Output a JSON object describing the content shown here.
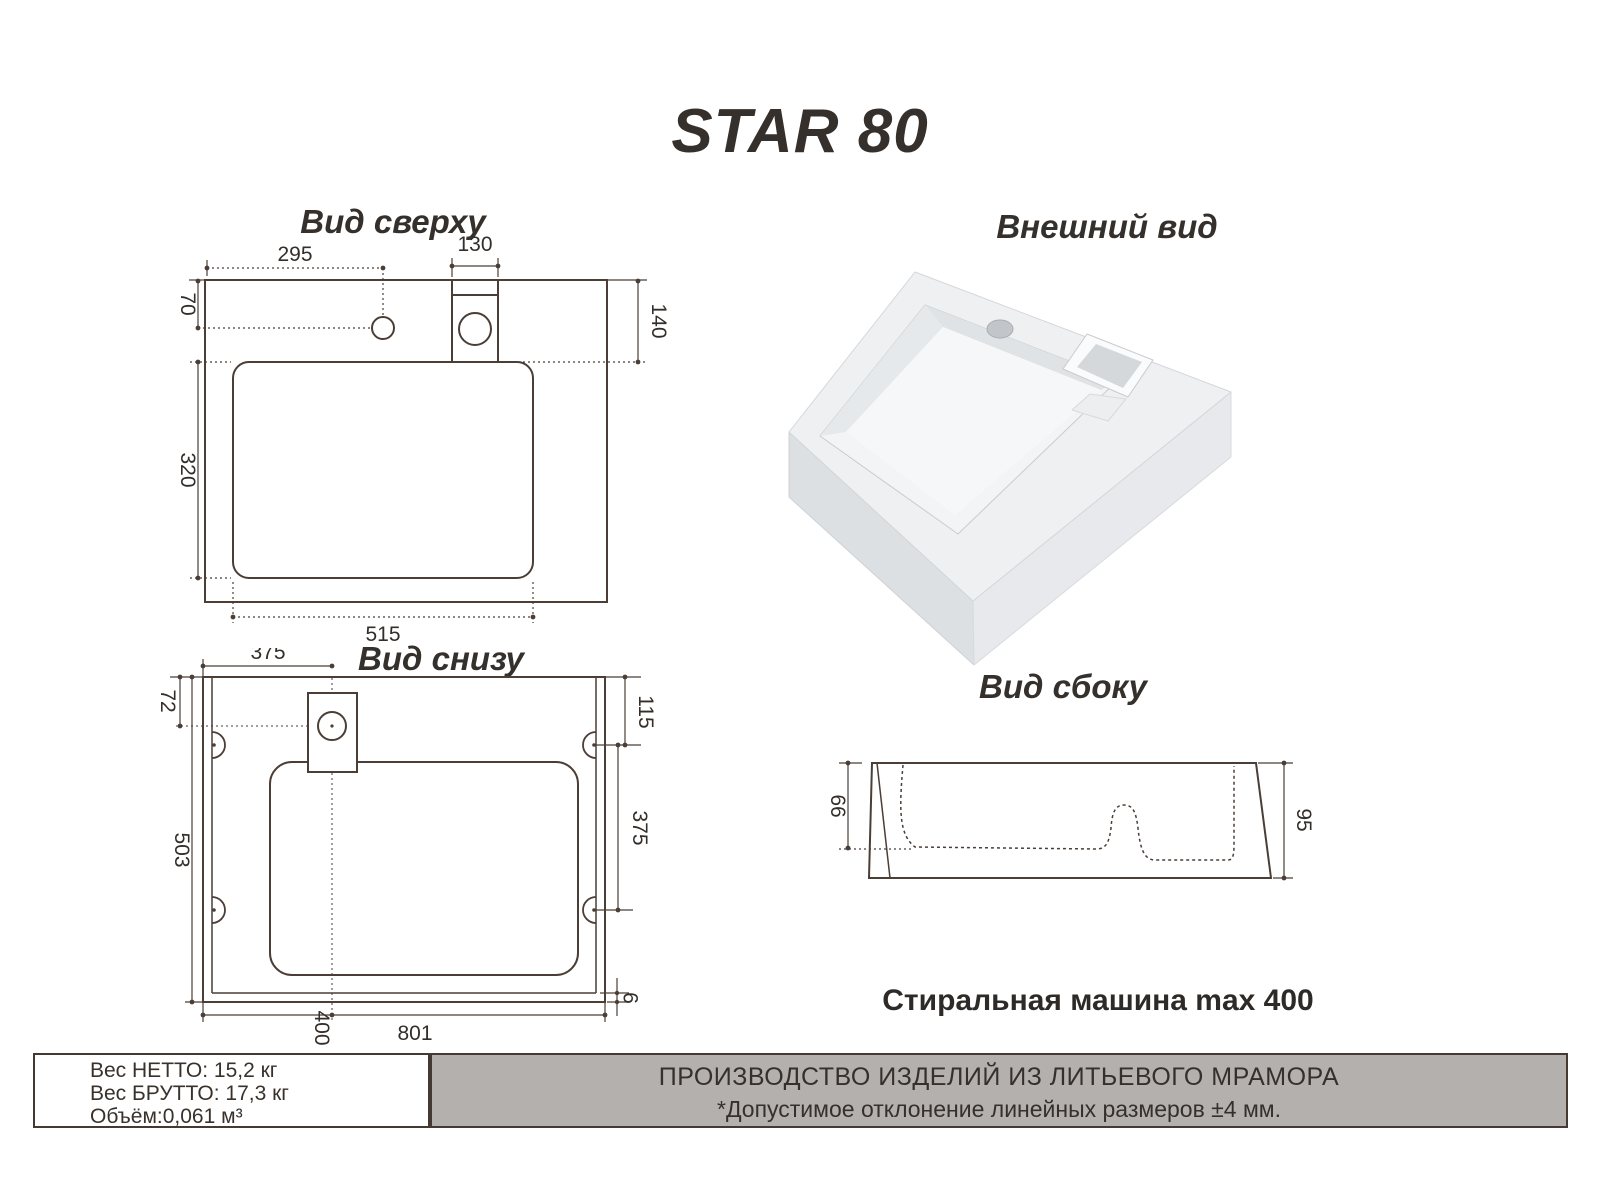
{
  "product": {
    "title": "STAR 80"
  },
  "views": {
    "top_view": {
      "title": "Вид сверху",
      "dims": {
        "faucet_x": "295",
        "drain_w": "130",
        "faucet_y": "70",
        "drain_h": "140",
        "basin_h": "320",
        "basin_w": "515"
      }
    },
    "bottom_view": {
      "title": "Вид снизу",
      "dims": {
        "drain_cx": "375",
        "drain_cy": "72",
        "hole_top": "115",
        "hole_pitch": "375",
        "depth": "503",
        "washer_cx": "400",
        "width": "801",
        "rim": "9"
      }
    },
    "external_view": {
      "title": "Внешний вид"
    },
    "side_view": {
      "title": "Вид сбоку",
      "dims": {
        "bowl_depth": "66",
        "height": "95"
      }
    }
  },
  "notes": {
    "washer": "Стиральная машина max 400"
  },
  "footer": {
    "net": "Вес НЕТТО: 15,2 кг",
    "gross": "Вес БРУТТО: 17,3 кг",
    "volume": "Объём:0,061 м³",
    "line1": "ПРОИЗВОДСТВО ИЗДЕЛИЙ ИЗ ЛИТЬЕВОГО МРАМОРА",
    "line2": "*Допустимое отклонение линейных размеров ±4 мм."
  },
  "colors": {
    "line": "#4a3e36",
    "text": "#332e2a",
    "footer_gray": "#b3b0ad"
  }
}
